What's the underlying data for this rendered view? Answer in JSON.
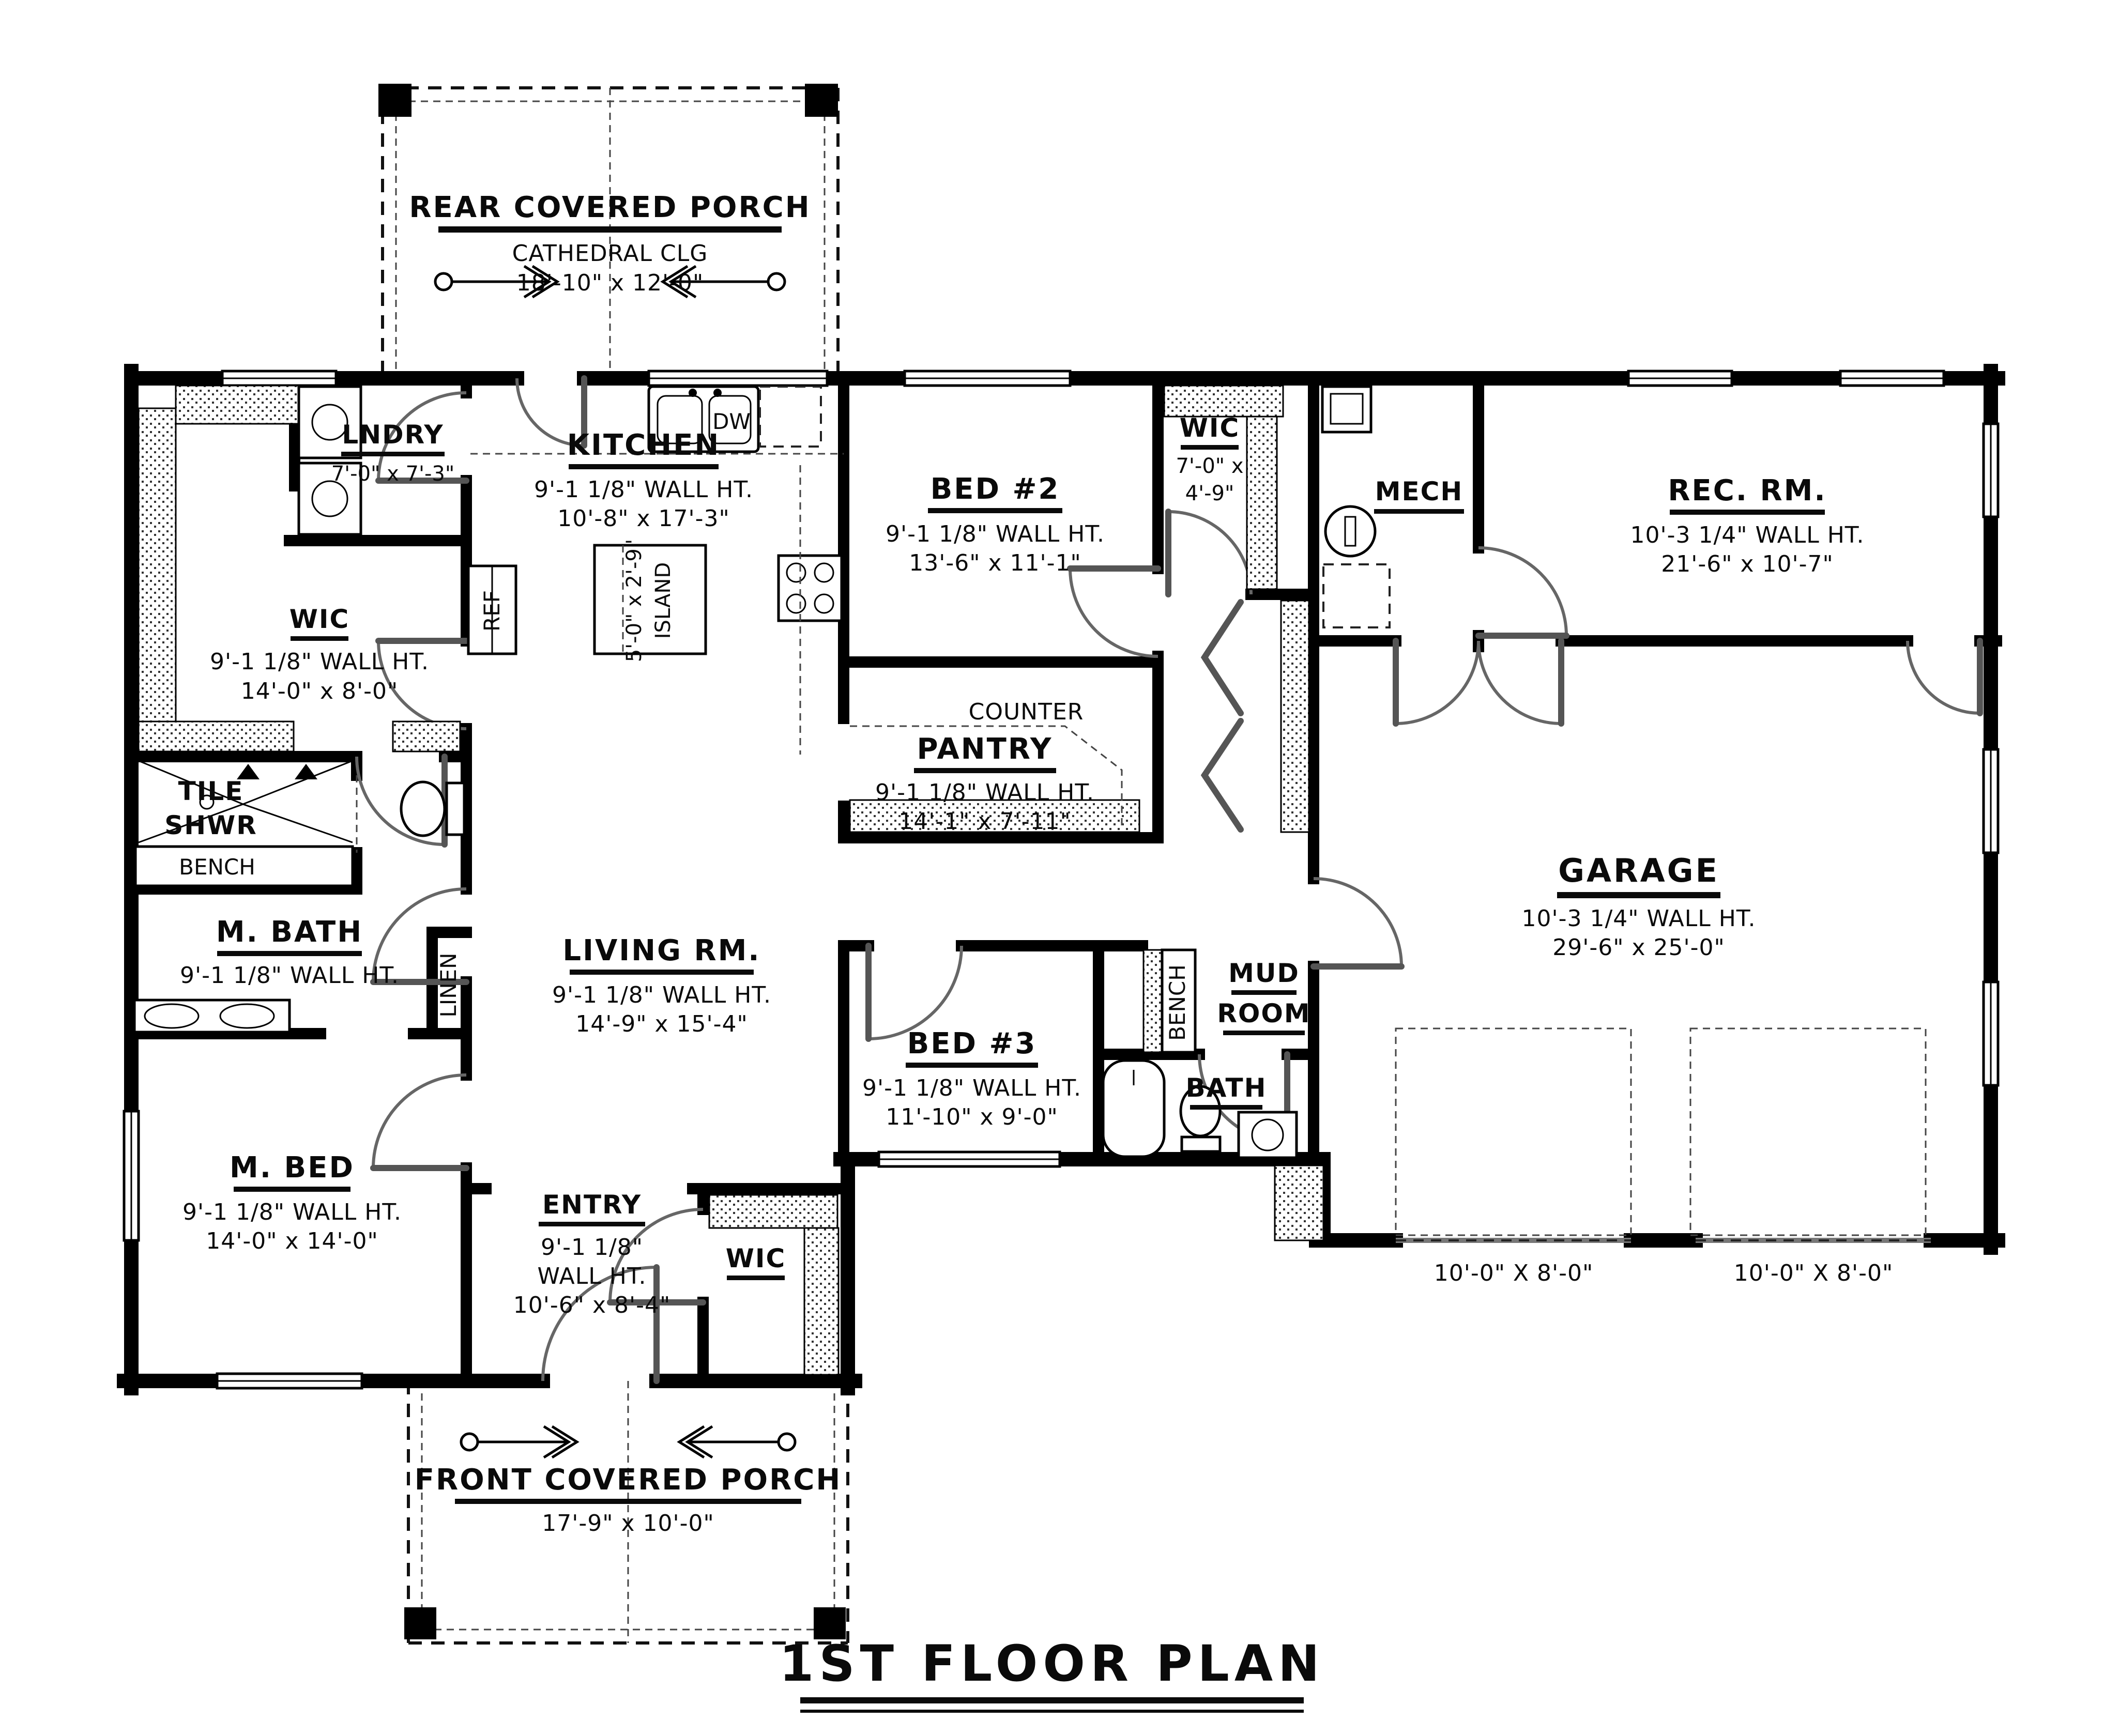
{
  "plan_title": "1ST FLOOR PLAN",
  "rooms": {
    "rear_porch": {
      "name": "REAR COVERED PORCH",
      "ceiling": "CATHEDRAL CLG",
      "dims": "18'-10\" x 12'-0\""
    },
    "lndry": {
      "name": "LNDRY",
      "dims": "7'-0\" x 7'-3\""
    },
    "kitchen": {
      "name": "KITCHEN",
      "wall": "9'-1 1/8\" WALL HT.",
      "dims": "10'-8\" x 17'-3\""
    },
    "island": {
      "line1": "5'-0\" x 2'-9\"",
      "line2": "ISLAND"
    },
    "bed2": {
      "name": "BED #2",
      "wall": "9'-1 1/8\" WALL HT.",
      "dims": "13'-6\" x 11'-1\""
    },
    "wic_bed2": {
      "name": "WIC",
      "dims_line1": "7'-0\" x",
      "dims_line2": "4'-9\""
    },
    "mech": {
      "name": "MECH"
    },
    "rec_rm": {
      "name": "REC. RM.",
      "wall": "10'-3 1/4\" WALL HT.",
      "dims": "21'-6\" x 10'-7\""
    },
    "wic_master": {
      "name": "WIC",
      "wall": "9'-1 1/8\" WALL HT.",
      "dims": "14'-0\" x 8'-0\""
    },
    "tile_shwr": {
      "line1": "TILE",
      "line2": "SHWR",
      "bench": "BENCH"
    },
    "pantry": {
      "name": "PANTRY",
      "wall": "9'-1 1/8\" WALL HT.",
      "dims": "14'-1\" x 7'-11\"",
      "counter": "COUNTER"
    },
    "m_bath": {
      "name": "M. BATH",
      "wall": "9'-1 1/8\" WALL HT.",
      "linen": "LINEN"
    },
    "living": {
      "name": "LIVING RM.",
      "wall": "9'-1 1/8\" WALL HT.",
      "dims": "14'-9\" x 15'-4\""
    },
    "bed3": {
      "name": "BED #3",
      "wall": "9'-1 1/8\" WALL HT.",
      "dims": "11'-10\" x 9'-0\""
    },
    "mud": {
      "line1": "MUD",
      "line2": "ROOM",
      "bench": "BENCH"
    },
    "bath": {
      "name": "BATH"
    },
    "m_bed": {
      "name": "M. BED",
      "wall": "9'-1 1/8\" WALL HT.",
      "dims": "14'-0\" x 14'-0\""
    },
    "entry": {
      "name": "ENTRY",
      "wall_line1": "9'-1 1/8\"",
      "wall_line2": "WALL HT.",
      "dims": "10'-6\" x 8'-4\""
    },
    "wic_entry": {
      "name": "WIC"
    },
    "garage": {
      "name": "GARAGE",
      "wall": "10'-3 1/4\" WALL HT.",
      "dims": "29'-6\" x 25'-0\"",
      "door1": "10'-0\" X 8'-0\"",
      "door2": "10'-0\" X 8'-0\""
    },
    "front_porch": {
      "name": "FRONT COVERED PORCH",
      "dims": "17'-9\" x 10'-0\""
    }
  },
  "appliances": {
    "dw": "DW",
    "ref": "REF"
  },
  "colors": {
    "ink": "#0a0a0a",
    "door": "#666666",
    "paper": "#ffffff"
  }
}
